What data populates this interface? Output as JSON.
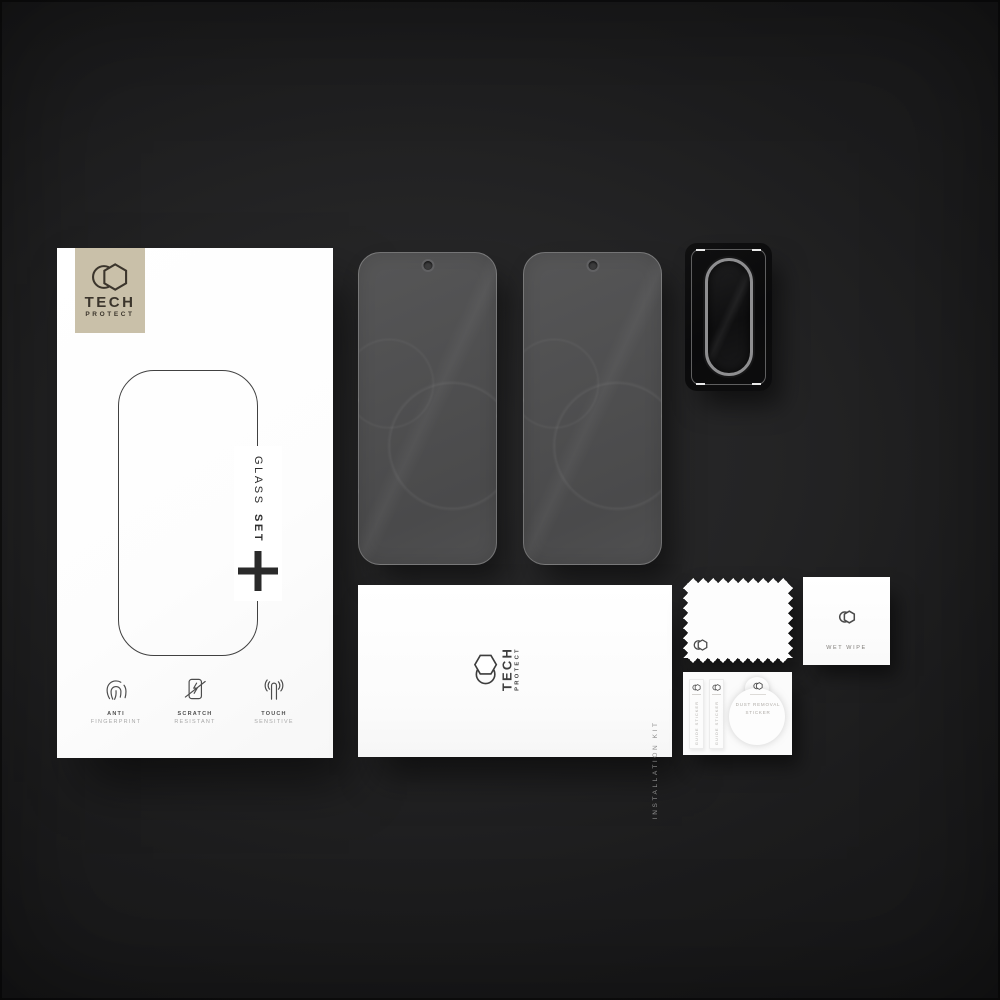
{
  "scene": {
    "description": "Tech-Protect Glass Set tempered glass kit flat-lay: retail box, two glass protectors, camera lens protector, installation kit envelope, cleaning cloth, wet wipe and stickers on dark background"
  },
  "colors": {
    "background": "#1c1c1d",
    "box_white": "#ffffff",
    "logo_beige": "#c9c0a9",
    "logo_text": "#3b352c",
    "glass_gray": "#4f4f50",
    "lens_black": "#0a0a0b"
  },
  "brand": {
    "name": "TECH",
    "subname": "PROTECT",
    "logo_icon": "hexagon-crescent-icon"
  },
  "box": {
    "glass_label": "GLASS",
    "set_label": "SET",
    "plus_mark": "+",
    "features": [
      {
        "icon": "fingerprint-icon",
        "title": "ANTI",
        "subtitle": "FINGERPRINT"
      },
      {
        "icon": "scratch-icon",
        "title": "SCRATCH",
        "subtitle": "RESISTANT"
      },
      {
        "icon": "touch-icon",
        "title": "TOUCH",
        "subtitle": "SENSITIVE"
      }
    ]
  },
  "envelope": {
    "label": "INSTALLATION KIT"
  },
  "wet_wipe": {
    "label": "WET WIPE"
  },
  "stickers": {
    "guide_label": "GUIDE STICKER",
    "dust_label_line1": "DUST REMOVAL",
    "dust_label_line2": "STICKER"
  }
}
